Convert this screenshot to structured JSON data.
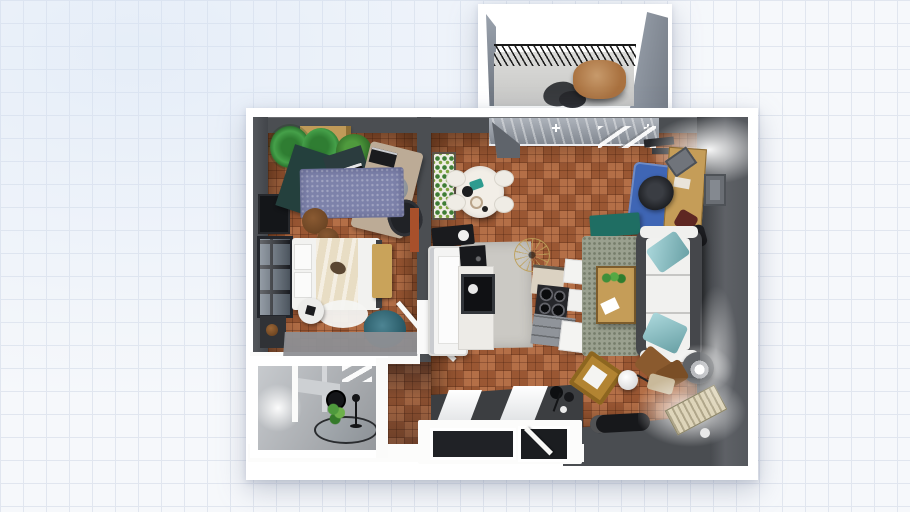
{
  "app": {
    "view_label": "3d-floor-plan-top-view",
    "background_style": "grid-paper"
  },
  "palette": {
    "paper": "#ffffff",
    "grid_line": "#e1e6ef",
    "wall": "#4b4e52",
    "wall_dark": "#3c3f43",
    "wood_floor": "#b06a42",
    "kitchen_mat": "#cbc9c4",
    "entry_floor": "#3c3e41",
    "bath_floor": "#b4b8bd",
    "rug_purple": "#7d82aa",
    "rug_blue": "#3f66b5",
    "rug_green": "#9aa08f",
    "rug_gray": "#8e8f93",
    "sofa_frame": "#45474b",
    "sofa_cushion": "#f1f1ef",
    "pillow_teal": "#7fc3c9",
    "pouf_teal": "#2e6f80",
    "console_teal": "#1f6e63",
    "wood_tan": "#c59d58",
    "bench_tan": "#c9a35a",
    "crate_tan": "#c09a58",
    "bed_white": "#f2f2f0",
    "blanket_cream": "#e8ddc4",
    "balcony_table_brown": "#a9713f",
    "glass_door_gray": "#99a0aa",
    "plant_green": "#3f8f3a",
    "appliance_black": "#17181a"
  },
  "scene": {
    "rooms": [
      {
        "name": "Balcony",
        "furniture": [
          "railing",
          "round table",
          "two chairs",
          "side walls"
        ]
      },
      {
        "name": "Bedroom",
        "furniture": [
          "double bed with cream blanket",
          "pillows",
          "bench",
          "teal pouf",
          "purple rug",
          "two palm plants",
          "bush plant",
          "wooden crate",
          "corner desk",
          "laptop desk",
          "office chair",
          "round chair",
          "wardrobe tv unit",
          "window",
          "brown poufs",
          "round side table",
          "white round rug",
          "gray runner rug",
          "open door"
        ]
      },
      {
        "name": "Dining",
        "furniture": [
          "round dining table with food",
          "four chairs",
          "plant shelf",
          "sink counter",
          "balcony sliding door"
        ]
      },
      {
        "name": "Kitchen",
        "furniture": [
          "tall fridge",
          "corner stove",
          "microwave",
          "cooktop with burners",
          "cabinets",
          "gray counter",
          "chandelier",
          "floor mat"
        ]
      },
      {
        "name": "Living Room",
        "furniture": [
          "white sofa with teal pillows",
          "green-gray rug",
          "coffee table with plant",
          "blue rug",
          "office chair",
          "wooden desk",
          "desk chairs",
          "teal console",
          "wall frame",
          "ceiling lights",
          "floor lamp",
          "media console",
          "gold chair",
          "ball lamp",
          "coat stand",
          "radiator with glow",
          "scattered chairs"
        ]
      },
      {
        "name": "Bathroom",
        "furniture": [
          "round rug",
          "mirror",
          "plant",
          "coat rack",
          "sink counter",
          "wall lamp glow",
          "ceiling light"
        ]
      },
      {
        "name": "Hallway",
        "furniture": [
          "wood floor",
          "door leaves"
        ]
      }
    ],
    "openings": [
      "balcony door",
      "bedroom door",
      "bathroom door",
      "bottom window",
      "entry door"
    ]
  }
}
